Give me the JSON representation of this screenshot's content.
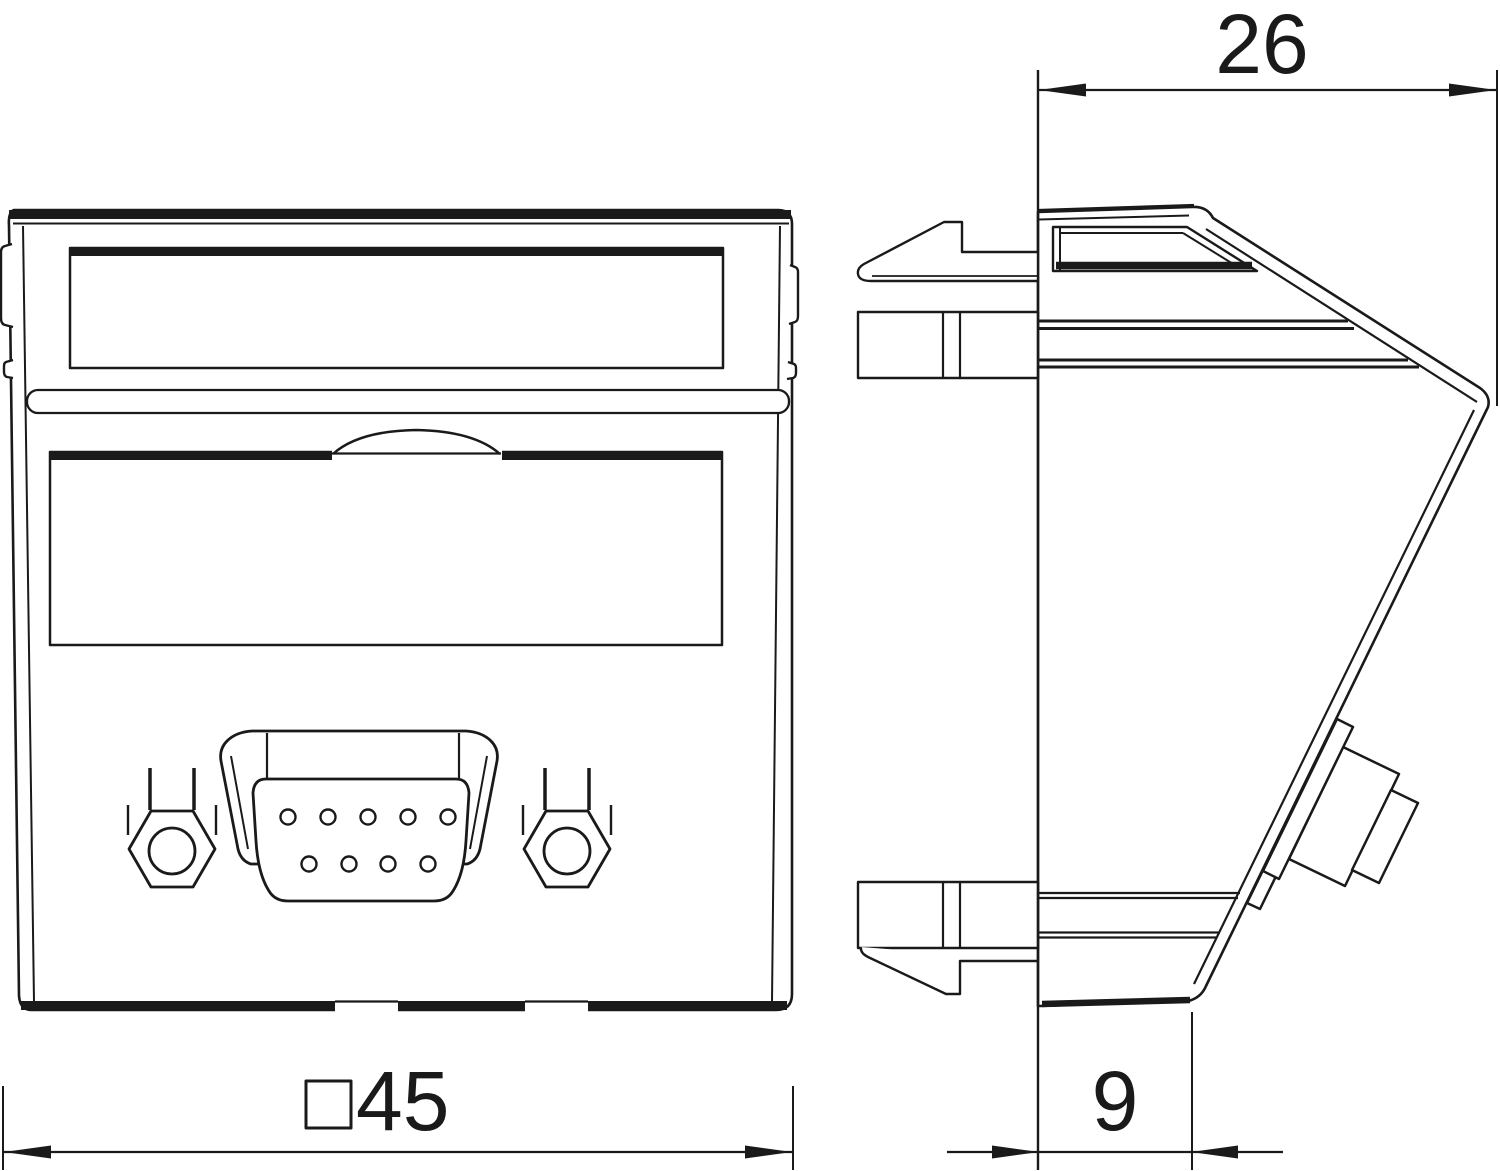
{
  "drawing": {
    "dimensions": {
      "top_width": "26",
      "front_size": "45",
      "depth": "9"
    },
    "icons": {
      "front_size_prefix": "square-symbol-icon"
    },
    "colors": {
      "line": "#1a1a1a",
      "background": "#ffffff"
    }
  }
}
